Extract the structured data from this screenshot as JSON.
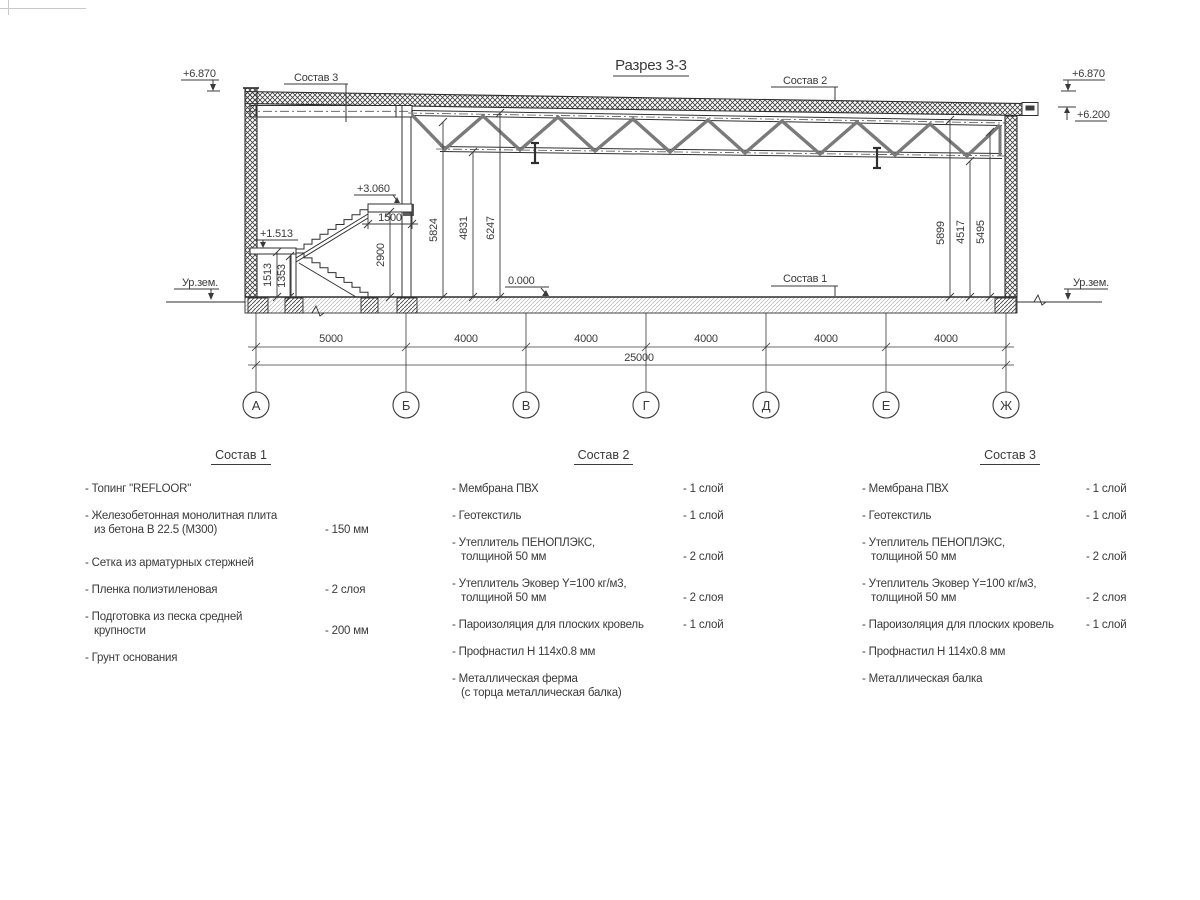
{
  "drawing": {
    "title": "Разрез 3-3",
    "callouts": {
      "c1": "Состав 1",
      "c2": "Состав 2",
      "c3": "Состав 3"
    },
    "levels": {
      "left_top": "+6.870",
      "right_top": "+6.870",
      "right_eave": "+6.200",
      "stair_upper": "+3.060",
      "stair_mid": "+1.513",
      "floor": "0.000",
      "ground_left": "Ур.зем.",
      "ground_right": "Ур.зем."
    },
    "dims": {
      "stair": {
        "d1513": "1513",
        "d1353": "1353",
        "d2900": "2900",
        "d1500": "1500"
      },
      "height_left": {
        "d5824": "5824",
        "d4831": "4831",
        "d6247": "6247"
      },
      "height_right": {
        "d5899": "5899",
        "d4517": "4517",
        "d5495": "5495"
      },
      "spans": [
        "5000",
        "4000",
        "4000",
        "4000",
        "4000",
        "4000"
      ],
      "total": "25000"
    },
    "axes": [
      "А",
      "Б",
      "В",
      "Г",
      "Д",
      "Е",
      "Ж"
    ]
  },
  "compositions": [
    {
      "title": "Состав 1",
      "items": [
        {
          "text": [
            "- Топинг \"REFLOOR\""
          ],
          "value": ""
        },
        {
          "text": [
            "- Железобетонная  монолитная плита",
            "из бетона В 22.5 (М300)"
          ],
          "value": "- 150 мм"
        },
        {
          "text": [
            "- Сетка из арматурных стержней"
          ],
          "value": ""
        },
        {
          "text": [
            "- Пленка полиэтиленовая"
          ],
          "value": "- 2 слоя"
        },
        {
          "text": [
            "- Подготовка из песка средней",
            "крупности"
          ],
          "value": "- 200 мм"
        },
        {
          "text": [
            "- Грунт основания"
          ],
          "value": ""
        }
      ]
    },
    {
      "title": "Состав 2",
      "items": [
        {
          "text": [
            "- Мембрана ПВХ"
          ],
          "value": "- 1 слой"
        },
        {
          "text": [
            "- Геотекстиль"
          ],
          "value": "- 1 слой"
        },
        {
          "text": [
            "- Утеплитель ПЕНОПЛЭКС,",
            "толщиной 50 мм"
          ],
          "value": "- 2 слой"
        },
        {
          "text": [
            "- Утеплитель Эковер Y=100 кг/м3,",
            "толщиной 50 мм"
          ],
          "value": "- 2 слоя"
        },
        {
          "text": [
            "- Пароизоляция для плоских кровель"
          ],
          "value": "- 1 слой"
        },
        {
          "text": [
            "- Профнастил Н 114х0.8 мм"
          ],
          "value": ""
        },
        {
          "text": [
            "- Металлическая ферма",
            "(с торца металлическая балка)"
          ],
          "value": ""
        }
      ]
    },
    {
      "title": "Состав 3",
      "items": [
        {
          "text": [
            "- Мембрана ПВХ"
          ],
          "value": "- 1 слой"
        },
        {
          "text": [
            "- Геотекстиль"
          ],
          "value": "- 1 слой"
        },
        {
          "text": [
            "- Утеплитель ПЕНОПЛЭКС,",
            "толщиной 50 мм"
          ],
          "value": "- 2 слой"
        },
        {
          "text": [
            "- Утеплитель Эковер Y=100 кг/м3,",
            "толщиной 50 мм"
          ],
          "value": "- 2 слоя"
        },
        {
          "text": [
            "- Пароизоляция для плоских кровель"
          ],
          "value": "- 1 слой"
        },
        {
          "text": [
            "- Профнастил Н 114х0.8 мм"
          ],
          "value": ""
        },
        {
          "text": [
            "- Металлическая балка"
          ],
          "value": ""
        }
      ]
    }
  ]
}
